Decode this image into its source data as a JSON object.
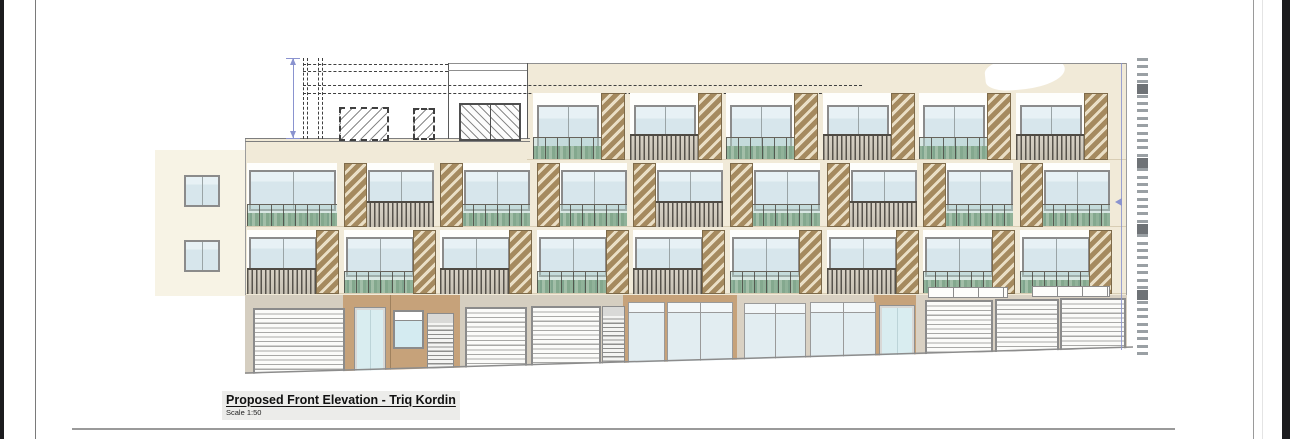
{
  "title_block": {
    "title": "Proposed Front Elevation - Triq Kordin",
    "scale_label": "Scale 1:50"
  },
  "colors": {
    "facade_cream": "#f1ead8",
    "adjacent_cream": "#f7f3e5",
    "recess_white": "#fefefc",
    "window_frame": "#8b8b8b",
    "ground_gray": "#d5cec0",
    "ground_beige": "#d9d1c3",
    "entrance_tan": "#c6a27a",
    "street_line": "#8c8c8c",
    "dim_blue": "#8a93cf",
    "ruler_dash": "#9aa0a4",
    "ruler_square": "#6e7276",
    "slab_line": "#d8cdb4",
    "edge_line": "#9c9c9c",
    "roof_line": "#7e7e7e"
  },
  "sheet": {
    "left_black_strip": {
      "x": 0,
      "w": 4
    },
    "right_black_strip": {
      "x": 1282,
      "w": 8
    },
    "border_left_x": 35,
    "border_right_x1": 1253,
    "border_right_x2": 1262,
    "bottom_line": {
      "y": 428,
      "x1": 72,
      "x2": 1175
    }
  },
  "elevation": {
    "adjacent": {
      "x": 155,
      "y": 150,
      "w": 90,
      "h": 146,
      "windows": [
        {
          "x": 184,
          "y": 175,
          "w": 32,
          "h": 28
        },
        {
          "x": 184,
          "y": 240,
          "w": 32,
          "h": 28
        }
      ]
    },
    "facade_blocks": [
      {
        "x": 527,
        "y": 63,
        "w": 600,
        "h": 232
      },
      {
        "x": 245,
        "y": 139,
        "w": 282,
        "h": 156
      }
    ],
    "parapet_highlight": {
      "x": 985,
      "y": 57,
      "w": 80,
      "h": 32
    },
    "slab_lines": [
      {
        "y": 159,
        "x1": 527,
        "x2": 1127
      },
      {
        "y": 226,
        "x1": 245,
        "x2": 1127
      },
      {
        "y": 293,
        "x1": 245,
        "x2": 1127
      }
    ],
    "edges": {
      "top": {
        "y": 63,
        "x1": 448,
        "x2": 1127
      },
      "left": {
        "x": 245,
        "y1": 139,
        "y2": 373
      },
      "right": {
        "x": 1126,
        "y1": 63,
        "y2": 350
      },
      "roof_double": {
        "x1": 245,
        "x2": 530,
        "y_a": 138,
        "y_b": 141
      }
    },
    "roof": {
      "dash_verticals": [
        303,
        307,
        318,
        322
      ],
      "dash_v_y1": 58,
      "dash_v_y2": 139,
      "dash_horizontals": [
        {
          "y": 64,
          "x1": 303,
          "x2": 448
        },
        {
          "y": 71,
          "x1": 303,
          "x2": 448
        },
        {
          "y": 85,
          "x1": 303,
          "x2": 862
        },
        {
          "y": 93,
          "x1": 303,
          "x2": 862
        }
      ],
      "hatch_dashed_boxes": [
        {
          "x": 339,
          "y": 107,
          "w": 46,
          "h": 30
        },
        {
          "x": 413,
          "y": 108,
          "w": 18,
          "h": 28
        }
      ],
      "solid_box": {
        "x1": 448,
        "x2": 527,
        "y1": 63,
        "y2": 139,
        "inner_line_y": 70
      },
      "hatch_solid_window": {
        "x": 459,
        "y": 103,
        "w": 58,
        "h": 34
      }
    },
    "floors": [
      {
        "id": "third-floor",
        "recess_y": 93,
        "recess_h": 65,
        "start_x": 533,
        "pitch": 96.5,
        "recess_w": 90,
        "louver_side": "right",
        "louver_w": 22,
        "window": {
          "dx": 4,
          "dy": 12,
          "w": 58,
          "h": 44
        },
        "modules": [
          {
            "r": "plants",
            "l": true
          },
          {
            "r": "slats",
            "l": true
          },
          {
            "r": "plants",
            "l": true
          },
          {
            "r": "slats",
            "l": true
          },
          {
            "r": "plants",
            "l": true
          },
          {
            "r": "slats",
            "l": true
          }
        ]
      },
      {
        "id": "second-floor",
        "recess_y": 163,
        "recess_h": 62,
        "start_x": 247,
        "pitch": 96.6,
        "recess_w": 90,
        "louver_side": "left",
        "louver_w": 21,
        "window": {
          "dx": 24,
          "dy": 7,
          "w": 62,
          "h": 37
        },
        "window_wide": {
          "dx": 2,
          "dy": 7,
          "w": 83,
          "h": 37
        },
        "modules": [
          {
            "r": "plants",
            "l": false
          },
          {
            "r": "slats",
            "l": true
          },
          {
            "r": "plants",
            "l": true
          },
          {
            "r": "plants",
            "l": true
          },
          {
            "r": "slats",
            "l": true
          },
          {
            "r": "plants",
            "l": true
          },
          {
            "r": "slats",
            "l": true
          },
          {
            "r": "plants",
            "l": true
          },
          {
            "r": "plants",
            "l": true
          }
        ]
      },
      {
        "id": "first-floor",
        "recess_y": 230,
        "recess_h": 62,
        "start_x": 247,
        "pitch": 96.6,
        "recess_w": 90,
        "louver_side": "right",
        "louver_w": 21,
        "window": {
          "dx": 2,
          "dy": 7,
          "w": 64,
          "h": 36
        },
        "modules": [
          {
            "r": "slats",
            "l": true
          },
          {
            "r": "plants",
            "l": true
          },
          {
            "r": "slats",
            "l": true
          },
          {
            "r": "plants",
            "l": true
          },
          {
            "r": "slats",
            "l": true
          },
          {
            "r": "plants",
            "l": true
          },
          {
            "r": "slats",
            "l": true
          },
          {
            "r": "plants",
            "l": true
          },
          {
            "r": "plants",
            "l": true
          }
        ]
      }
    ],
    "ground_walls": [
      {
        "x": 245,
        "y": 295,
        "w": 378,
        "h": 80,
        "color": "ground_gray"
      },
      {
        "x": 343,
        "y": 295,
        "w": 117,
        "h": 80,
        "color": "entrance_tan"
      },
      {
        "x": 623,
        "y": 295,
        "w": 114,
        "h": 78,
        "color": "entrance_tan"
      },
      {
        "x": 737,
        "y": 295,
        "w": 390,
        "h": 72,
        "color": "ground_beige"
      },
      {
        "x": 874,
        "y": 295,
        "w": 42,
        "h": 70,
        "color": "entrance_tan"
      }
    ],
    "entrance_joint_x": 390,
    "ground_units": [
      {
        "type": "garage",
        "x": 253,
        "y": 308,
        "w": 88,
        "h": 68
      },
      {
        "type": "glass_door",
        "x": 355,
        "y": 308,
        "w": 26,
        "h": 64
      },
      {
        "type": "window_small",
        "x": 393,
        "y": 310,
        "w": 27,
        "h": 35
      },
      {
        "type": "louver_door",
        "x": 427,
        "y": 313,
        "w": 25,
        "h": 59
      },
      {
        "type": "garage",
        "x": 465,
        "y": 307,
        "w": 58,
        "h": 67
      },
      {
        "type": "garage",
        "x": 531,
        "y": 306,
        "w": 66,
        "h": 66
      },
      {
        "type": "louver_door",
        "x": 602,
        "y": 306,
        "w": 21,
        "h": 62
      },
      {
        "type": "shopfront",
        "x": 628,
        "y": 302,
        "w": 35,
        "h": 66
      },
      {
        "type": "shopfront",
        "x": 667,
        "y": 302,
        "w": 64,
        "h": 66
      },
      {
        "type": "shopfront",
        "x": 744,
        "y": 303,
        "w": 60,
        "h": 62
      },
      {
        "type": "shopfront",
        "x": 810,
        "y": 302,
        "w": 64,
        "h": 60
      },
      {
        "type": "glass_door",
        "x": 880,
        "y": 306,
        "w": 30,
        "h": 58
      },
      {
        "type": "transom",
        "x": 928,
        "y": 287,
        "w": 78,
        "h": 9
      },
      {
        "type": "transom",
        "x": 1032,
        "y": 286,
        "w": 76,
        "h": 9
      },
      {
        "type": "garage",
        "x": 925,
        "y": 300,
        "w": 64,
        "h": 56
      },
      {
        "type": "garage",
        "x": 995,
        "y": 299,
        "w": 60,
        "h": 54
      },
      {
        "type": "garage",
        "x": 1060,
        "y": 298,
        "w": 62,
        "h": 52
      }
    ],
    "street": {
      "x1": 245,
      "y1": 373,
      "x2": 1133,
      "y2": 347
    },
    "ruler": {
      "x": 1137,
      "y0": 58,
      "pitch": 7.35,
      "count": 41,
      "dash_w": 11,
      "dash_h": 2.5,
      "square_indices": [
        4,
        14,
        23,
        32
      ],
      "square_w": 11,
      "square_h": 10
    },
    "dims": {
      "left": {
        "x": 293,
        "y1": 58,
        "y2": 138
      },
      "right": {
        "x": 1121,
        "y1": 63,
        "y2": 350,
        "arrow_y": 202
      }
    }
  }
}
